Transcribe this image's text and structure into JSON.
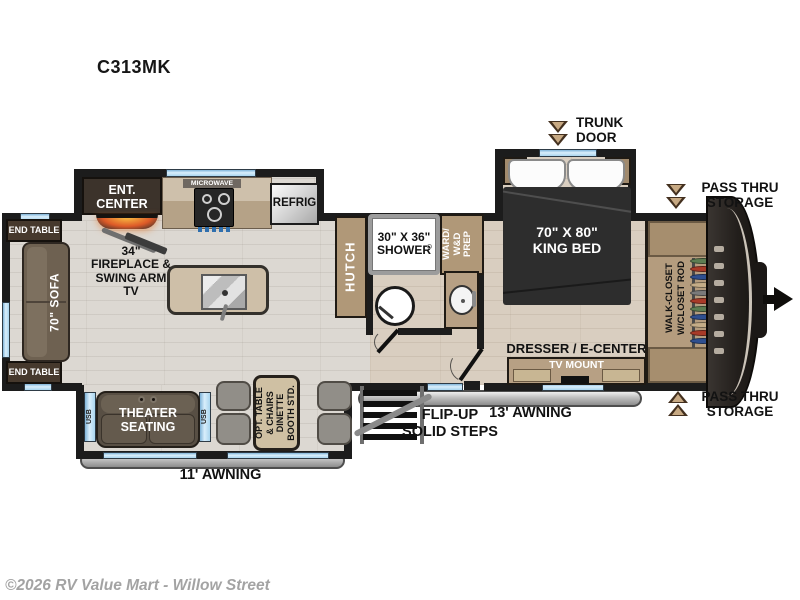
{
  "title": "C313MK",
  "watermark": "©2026 RV Value Mart - Willow Street",
  "floorplan": {
    "kitchen": {
      "ent_center": [
        "ENT.",
        "CENTER"
      ],
      "microwave": "MICROWAVE",
      "refrig": "REFRIG",
      "fireplace": [
        "34\"",
        "FIREPLACE &",
        "SWING ARM",
        "TV"
      ]
    },
    "living": {
      "end_table_top": "END TABLE",
      "end_table_bottom": "END TABLE",
      "sofa": "70\" SOFA",
      "theater": [
        "THEATER",
        "SEATING"
      ],
      "usb_left": "USB",
      "usb_right": "USB",
      "dinette": [
        "OPT. TABLE",
        "& CHAIRS",
        "DINETTE",
        "BOOTH STD."
      ]
    },
    "bath": {
      "hutch": "HUTCH",
      "shower": [
        "30\" X 36\"",
        "SHOWER"
      ],
      "ward": [
        "WARD/",
        "W&D",
        "PREP"
      ]
    },
    "bedroom": {
      "bed": [
        "70\" X 80\"",
        "KING BED"
      ],
      "trunk_door": [
        "TRUNK",
        "DOOR"
      ],
      "dresser": "DRESSER / E-CENTER",
      "tv_mount": "TV MOUNT"
    },
    "closet_label": [
      "WALK-CLOSET",
      "W/CLOSET ROD"
    ],
    "closet_hangers": [
      "#5d7d52",
      "#a83a28",
      "#2f4f8f",
      "#c4ad88",
      "#7a7a7a",
      "#a83a28",
      "#5d7d52",
      "#2f4f8f",
      "#c4ad88",
      "#a83a28",
      "#2f4f8f"
    ],
    "storage_top": [
      "PASS THRU",
      "STORAGE"
    ],
    "storage_bottom": [
      "PASS THRU",
      "STORAGE"
    ],
    "exterior": {
      "awning_13": "13' AWNING",
      "awning_11": "11' AWNING",
      "steps": [
        "FLIP-UP",
        "SOLID STEPS"
      ]
    }
  },
  "colors": {
    "wall": "#1c1c1c",
    "window": "#a9d5ef",
    "cabinet_tan": "#b29878",
    "counter": "#c9b9a0",
    "dark_wood": "#3c332b",
    "floor": "#dcd8d2",
    "bedroom_floor": "#d9cec0",
    "sofa": "#6e6151",
    "bed": "#2d2d2d",
    "bench_gray": "#918e88",
    "awning_gray": "#bdbdbd",
    "arrow_brown": "#43301f"
  }
}
